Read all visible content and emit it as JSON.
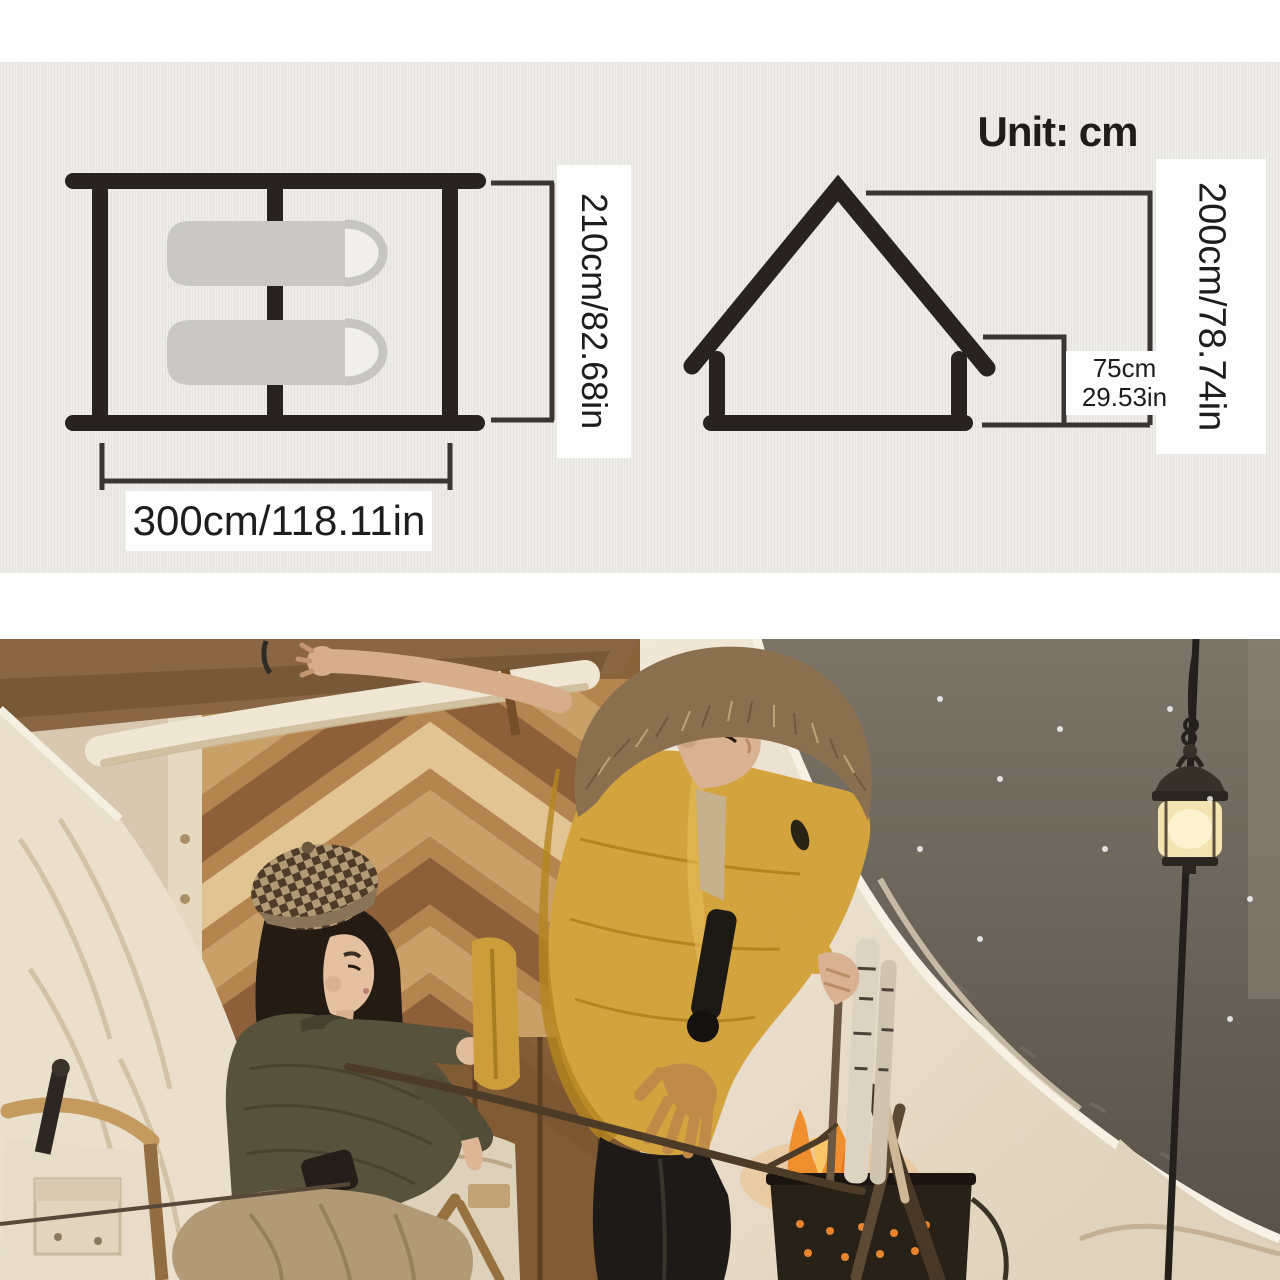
{
  "colors": {
    "panel_bg": "#eeece9",
    "diagram_ink": "#282220",
    "pad_gray": "#c9c8c5",
    "label_bg": "#fdfdfd",
    "label_text": "#1f1d1b",
    "canvas_light": "#ece1cf",
    "jacket_yellow": "#d3a33e",
    "olive_jacket": "#56523c",
    "fur_brown": "#8b7050",
    "fire_orange": "#f08f2e",
    "lantern_glow": "#f2e5b3"
  },
  "diagram": {
    "unit_label": "Unit: cm",
    "top_view": {
      "depth_label": "210cm/82.68in",
      "width_label": "300cm/118.11in"
    },
    "side_view": {
      "height_label": "200cm/78.74in",
      "wall_height_cm": "75cm",
      "wall_height_in": "29.53in"
    }
  },
  "photo": {
    "alt": "Couple tending a campfire in front of a beige canvas cabin tent with a hanging lantern"
  }
}
